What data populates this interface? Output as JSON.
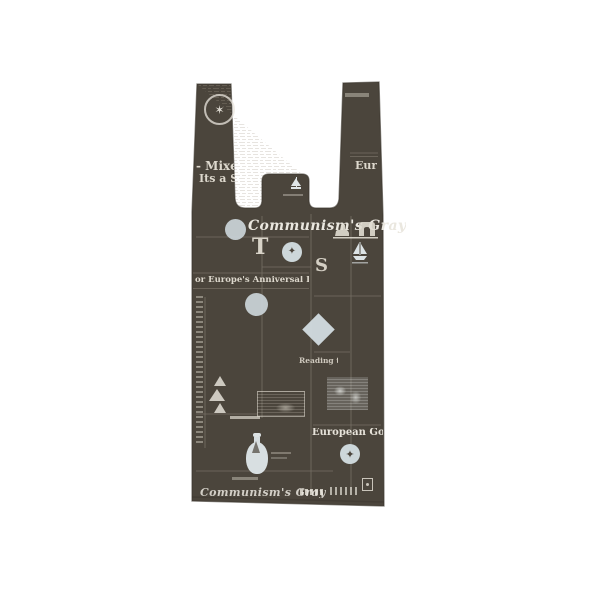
{
  "page": {
    "background": "#ffffff"
  },
  "product": {
    "type": "t-shirt-style plastic carrier bag with newspaper print",
    "bag_color": "#4b453c",
    "edge_color": "#3a352d",
    "ink_light": "#e8e4da",
    "ink_pale_blue": "#ccd6da"
  },
  "icons": {
    "handle_crest": "star-seal",
    "tab": "sailboat",
    "monuments": "sphinx-and-arch",
    "boat": "sailboat",
    "moon": "full-moon",
    "diamond": "diamond",
    "mountains": "mountains",
    "bottle": "ship-in-bottle",
    "eagle_seal": "eagle-seal",
    "stamp": "postage-stamp"
  },
  "print": {
    "handle_left": {
      "crest_glyph": "✶",
      "headline_top": "- Mixed",
      "headline_bottom": "Its a Su"
    },
    "handle_right": {
      "headline": "Eur"
    },
    "body": {
      "masthead_script": "Communism's Gray",
      "drop_cap_t": "T",
      "drop_cap_s": "S",
      "column_headline_left": "or Europe's Anniversal Drive",
      "column_headline_right": "Reading the Skies",
      "lower_right_headline": "European Good Se",
      "bottom_script": "Communism's Gray",
      "seal_glyph": "✦"
    }
  }
}
